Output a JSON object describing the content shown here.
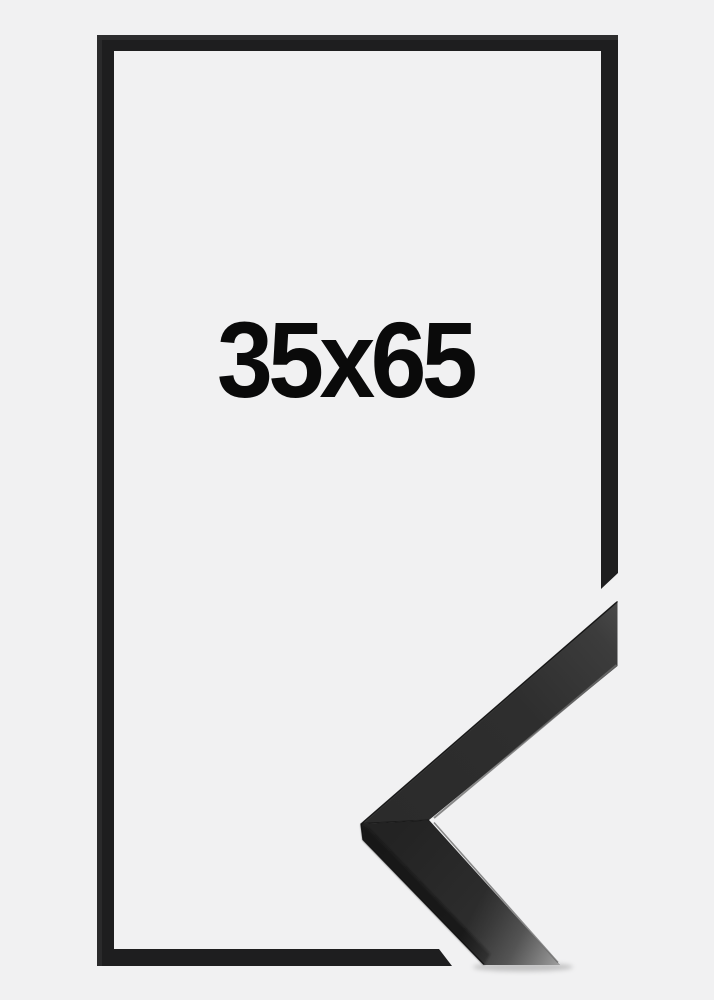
{
  "product": {
    "size_label": "35x65"
  },
  "colors": {
    "page_background": "#f1f1f2",
    "frame_outline": "#1e1e1f",
    "frame_outline_highlight": "#2f2f30",
    "label_text": "#0a0a0a",
    "molding_face_dark": "#262626",
    "molding_face_tip": "#4a4a4a",
    "molding_side_facet": "#191919",
    "molding_edge_highlight": "#6e6e6e",
    "molding_end_sheen": "#b5b5b5"
  }
}
